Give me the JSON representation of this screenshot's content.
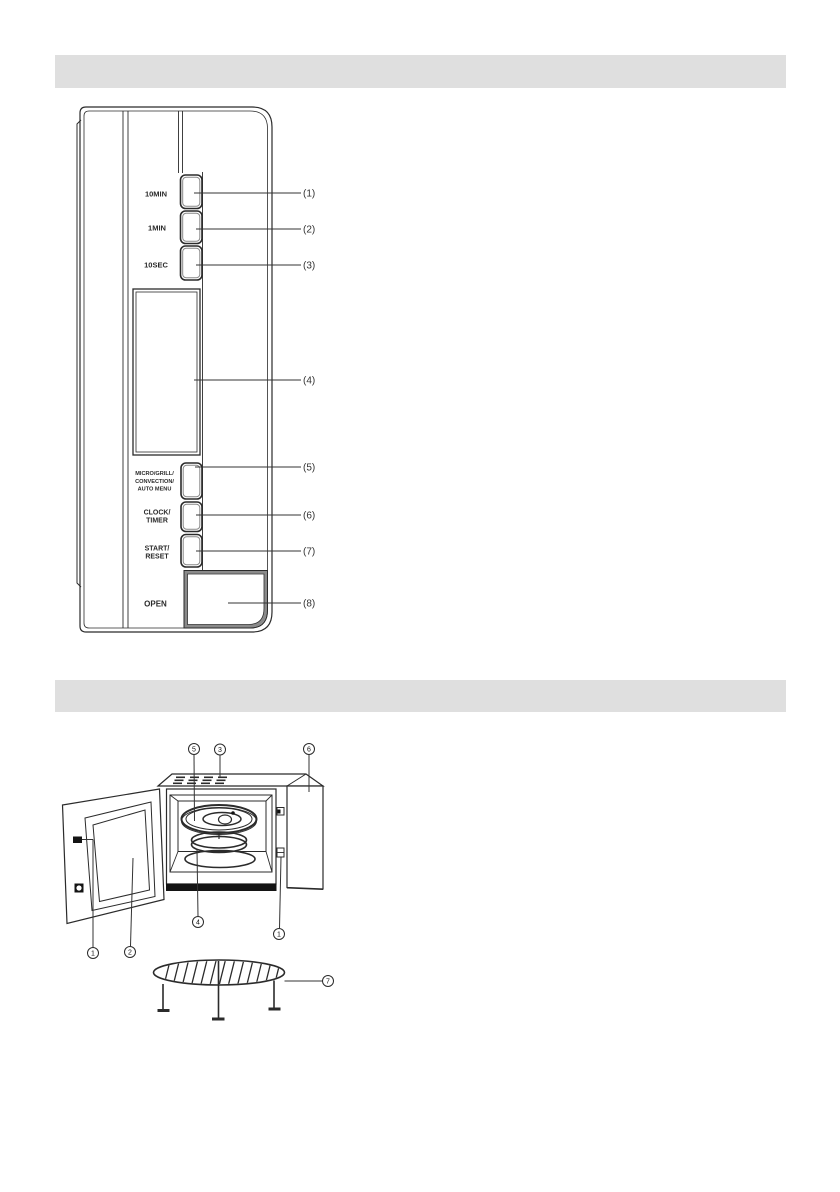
{
  "page": {
    "background": "#ffffff",
    "section_bar_color": "#dfdfdf"
  },
  "panel": {
    "labels": {
      "btn1": "10MIN",
      "btn2": "1MIN",
      "btn3": "10SEC",
      "btn5_l1": "MICRO/GRILL/",
      "btn5_l2": "CONVECTION/",
      "btn5_l3": "AUTO MENU",
      "btn6_l1": "CLOCK/",
      "btn6_l2": "TIMER",
      "btn7_l1": "START/",
      "btn7_l2": "RESET",
      "btn8": "OPEN"
    },
    "callouts": [
      "(1)",
      "(2)",
      "(3)",
      "(4)",
      "(5)",
      "(6)",
      "(7)",
      "(8)"
    ]
  },
  "oven": {
    "callouts": {
      "tray": "5",
      "vent": "3",
      "panel_box": "6",
      "latch_left": "1",
      "window": "2",
      "ring": "4",
      "latch_right": "1",
      "rack": "7"
    }
  }
}
